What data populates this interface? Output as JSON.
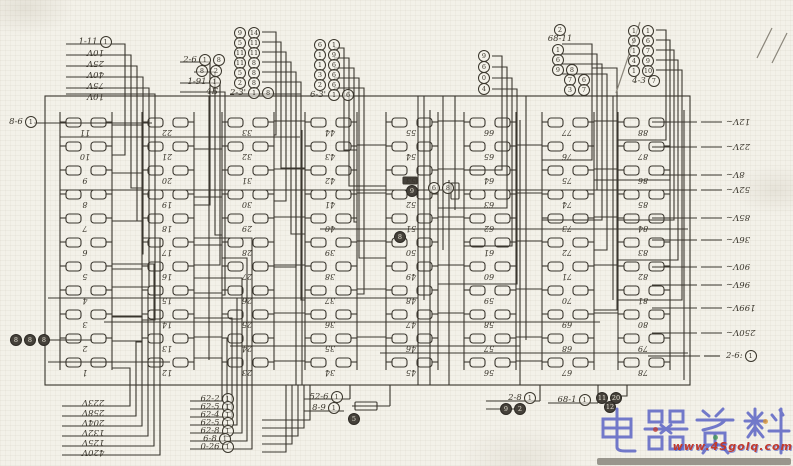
{
  "colors": {
    "ink": "#3a362e",
    "paper": "#f3f1e9",
    "watermark_blue": "#4f58c2",
    "watermark_red": "#c23a2c",
    "bar_gray": "#8f8c83"
  },
  "strips": [
    {
      "x": 86,
      "terminals": [
        "11",
        "10",
        "9",
        "8",
        "7",
        "6",
        "5",
        "4",
        "3",
        "2",
        "1"
      ]
    },
    {
      "x": 168,
      "terminals": [
        "22",
        "21",
        "20",
        "19",
        "18",
        "17",
        "16",
        "15",
        "14",
        "13",
        "12"
      ]
    },
    {
      "x": 248,
      "terminals": [
        "33",
        "32",
        "31",
        "30",
        "29",
        "28",
        "27",
        "26",
        "25",
        "24",
        "23"
      ]
    },
    {
      "x": 331,
      "terminals": [
        "44",
        "43",
        "42",
        "41",
        "40",
        "39",
        "38",
        "37",
        "36",
        "35",
        "34"
      ]
    },
    {
      "x": 412,
      "terminals": [
        "55",
        "54",
        "53",
        "52",
        "51",
        "50",
        "49",
        "48",
        "47",
        "46",
        "45"
      ]
    },
    {
      "x": 490,
      "terminals": [
        "66",
        "65",
        "64",
        "63",
        "62",
        "61",
        "60",
        "59",
        "58",
        "57",
        "56"
      ]
    },
    {
      "x": 568,
      "terminals": [
        "77",
        "76",
        "75",
        "74",
        "73",
        "72",
        "71",
        "70",
        "69",
        "68",
        "67"
      ]
    },
    {
      "x": 644,
      "terminals": [
        "88",
        "87",
        "86",
        "85",
        "84",
        "83",
        "82",
        "81",
        "80",
        "79",
        "78"
      ]
    }
  ],
  "top_stacks": [
    {
      "x": 66,
      "y": 36,
      "dy": 11,
      "w": 58,
      "rows": [
        {
          "code": "1-11",
          "circles": [
            "1"
          ]
        },
        {
          "rot": "10V"
        },
        {
          "rot": "25V"
        },
        {
          "rot": "40V"
        },
        {
          "rot": "75V"
        },
        {
          "rot": "10V"
        }
      ]
    },
    {
      "x": 180,
      "y": 54,
      "dy": 11,
      "w": 48,
      "rows": [
        {
          "code": "2-6",
          "circles": [
            "1",
            "8"
          ]
        },
        {
          "circles": [
            "8",
            "2"
          ],
          "indent": 16
        },
        {
          "code": "1-91",
          "circles": [
            "1"
          ]
        },
        {
          "code": "4Б",
          "indent": 8
        }
      ]
    },
    {
      "x": 234,
      "y": 27,
      "dy": 10,
      "w": 36,
      "rows": [
        {
          "circles": [
            "9",
            "14"
          ]
        },
        {
          "circles": [
            "5",
            "11"
          ]
        },
        {
          "circles": [
            "11",
            "11"
          ]
        },
        {
          "circles": [
            "11",
            "8"
          ]
        },
        {
          "circles": [
            "5",
            "8"
          ]
        },
        {
          "circles": [
            "2",
            "8"
          ]
        },
        {
          "code": "2-3'",
          "circles": [
            "1",
            "8"
          ]
        }
      ]
    },
    {
      "x": 314,
      "y": 39,
      "dy": 10,
      "w": 36,
      "rows": [
        {
          "circles": [
            "6",
            "1"
          ]
        },
        {
          "circles": [
            "1",
            "9"
          ]
        },
        {
          "circles": [
            "1",
            "6"
          ]
        },
        {
          "circles": [
            "3",
            "6"
          ]
        },
        {
          "circles": [
            "2",
            "6"
          ]
        },
        {
          "code": "6-3'",
          "circles": [
            "1",
            "6"
          ]
        }
      ]
    },
    {
      "x": 478,
      "y": 50,
      "dy": 11,
      "w": 22,
      "rows": [
        {
          "circles": [
            "9"
          ]
        },
        {
          "circles": [
            "6"
          ]
        },
        {
          "circles": [
            "0"
          ]
        },
        {
          "circles": [
            "4"
          ]
        }
      ]
    },
    {
      "x": 532,
      "y": 24,
      "dy": 10,
      "w": 56,
      "rows": [
        {
          "circles": [
            "2"
          ],
          "indent": 22
        },
        {
          "code": "68-11"
        },
        {
          "circles": [
            "1"
          ],
          "indent": 20
        },
        {
          "circles": [
            "6"
          ],
          "indent": 20
        },
        {
          "circles": [
            "9",
            "8"
          ],
          "indent": 20
        },
        {
          "circles": [
            "7",
            "6"
          ],
          "indent": 32
        },
        {
          "circles": [
            "3",
            "7"
          ],
          "indent": 32
        }
      ]
    },
    {
      "x": 628,
      "y": 25,
      "dy": 10,
      "w": 36,
      "rows": [
        {
          "circles": [
            "1",
            "1"
          ]
        },
        {
          "circles": [
            "9",
            "6"
          ]
        },
        {
          "circles": [
            "1",
            "7"
          ]
        },
        {
          "circles": [
            "4",
            "9"
          ]
        },
        {
          "circles": [
            "1",
            "10"
          ]
        },
        {
          "code": "4-3",
          "circles": [
            "7"
          ]
        }
      ]
    }
  ],
  "bottom_stacks": [
    {
      "x": 62,
      "y": 397,
      "dy": 10,
      "w": 62,
      "rows": [
        {
          "rot": "223V"
        },
        {
          "rot": "258V"
        },
        {
          "rot": "204V"
        },
        {
          "rot": "132V"
        },
        {
          "rot": "125V"
        },
        {
          "rot": "420V"
        }
      ]
    },
    {
      "x": 190,
      "y": 393,
      "dy": 8,
      "w": 54,
      "rows": [
        {
          "code": "62-2",
          "circles": [
            "1"
          ]
        },
        {
          "code": "62-5",
          "circles": [
            "1"
          ]
        },
        {
          "code": "62-4",
          "circles": [
            "1"
          ]
        },
        {
          "code": "62-5",
          "circles": [
            "1"
          ]
        },
        {
          "code": "62-8",
          "circles": [
            "1"
          ]
        },
        {
          "code": "6-8",
          "circles": [
            "1"
          ]
        },
        {
          "code": "0-26",
          "circles": [
            "1"
          ]
        }
      ]
    },
    {
      "x": 302,
      "y": 391,
      "dy": 11,
      "w": 48,
      "rows": [
        {
          "code": "52-6",
          "circles": [
            "1"
          ]
        },
        {
          "code": "8-9",
          "circles": [
            "1"
          ]
        },
        {
          "circles": [
            "5"
          ],
          "dark": true,
          "indent": 46
        }
      ]
    },
    {
      "x": 486,
      "y": 392,
      "dy": 11,
      "w": 52,
      "rows": [
        {
          "code": "2-8",
          "circles": [
            "1"
          ],
          "indent": 10
        },
        {
          "circles": [
            "9",
            "2"
          ],
          "dark": true,
          "indent": 14
        }
      ]
    },
    {
      "x": 548,
      "y": 394,
      "dy": 10,
      "w": 52,
      "rows": [
        {
          "code": "68-1",
          "circles": [
            "1"
          ]
        }
      ]
    },
    {
      "x": 596,
      "y": 392,
      "dy": 9,
      "w": 42,
      "rows": [
        {
          "circles": [
            "11",
            "20"
          ],
          "dark": true
        },
        {
          "circles": [
            "12"
          ],
          "dark": true,
          "indent": 8
        }
      ]
    }
  ],
  "left_labels": {
    "code_label": {
      "code": "8-6",
      "circles": [
        "1"
      ]
    },
    "trio": [
      "8",
      "8",
      "8"
    ]
  },
  "right_labels": {
    "voltages": [
      "12V~",
      "22V~",
      "8V~",
      "52V~",
      "85V~",
      "36V~",
      "90V~",
      "96V~",
      "199V~",
      "250V~"
    ],
    "code": {
      "code": "2-6:",
      "circles": [
        "1"
      ]
    }
  },
  "inline_marks": [
    {
      "d": "6",
      "dark": false
    },
    {
      "d": "8",
      "dark": false
    },
    {
      "d": "9",
      "dark": true
    },
    {
      "d": "8",
      "dark": true
    }
  ],
  "watermark": {
    "title": "电器资料",
    "url": "www.4Sgolq.com"
  }
}
